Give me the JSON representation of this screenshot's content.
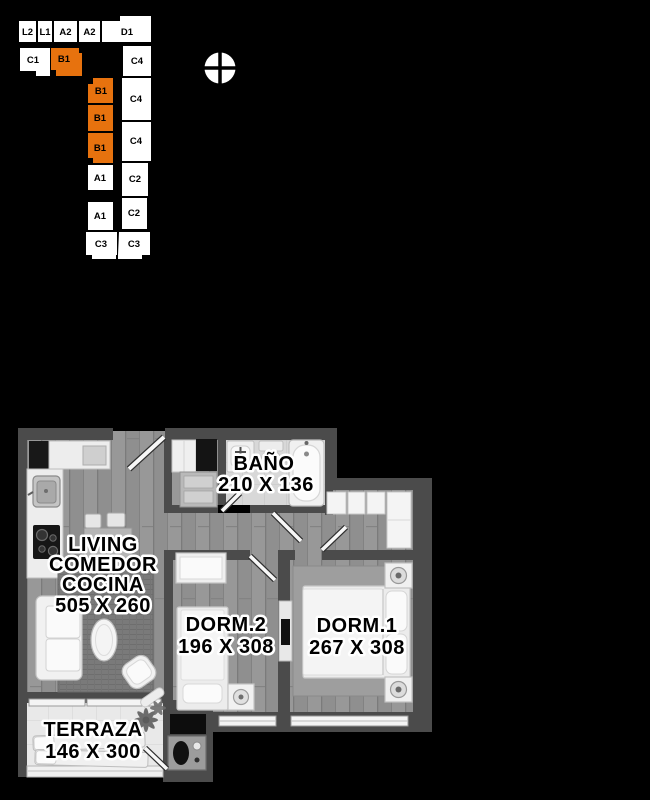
{
  "background_color": "#000000",
  "minimap": {
    "highlight_color": "#E7720E",
    "highlight_text_color": "#5B2600",
    "unit_fill": "#FFFFFF",
    "units": [
      {
        "label": "L2",
        "highlighted": false
      },
      {
        "label": "L1",
        "highlighted": false
      },
      {
        "label": "A2",
        "highlighted": false
      },
      {
        "label": "A2",
        "highlighted": false
      },
      {
        "label": "D1",
        "highlighted": false
      },
      {
        "label": "C1",
        "highlighted": false
      },
      {
        "label": "B1",
        "highlighted": true
      },
      {
        "label": "C4",
        "highlighted": false
      },
      {
        "label": "B1",
        "highlighted": true
      },
      {
        "label": "C4",
        "highlighted": false
      },
      {
        "label": "B1",
        "highlighted": true
      },
      {
        "label": "C4",
        "highlighted": false
      },
      {
        "label": "B1",
        "highlighted": true
      },
      {
        "label": "A1",
        "highlighted": false
      },
      {
        "label": "C2",
        "highlighted": false
      },
      {
        "label": "A1",
        "highlighted": false
      },
      {
        "label": "C2",
        "highlighted": false
      },
      {
        "label": "C3",
        "highlighted": false
      },
      {
        "label": "C3",
        "highlighted": false
      }
    ]
  },
  "floorplan": {
    "rooms": {
      "bano": {
        "label": "BAÑO",
        "dims": "210 X 136"
      },
      "living": {
        "line1": "LIVING",
        "line2": "COMEDOR",
        "line3": "COCINA",
        "dims": "505 X 260"
      },
      "dorm2": {
        "label": "DORM.2",
        "dims": "196 X 308"
      },
      "dorm1": {
        "label": "DORM.1",
        "dims": "267 X 308"
      },
      "terraza": {
        "label": "TERRAZA",
        "dims": "146 X 300"
      }
    }
  }
}
